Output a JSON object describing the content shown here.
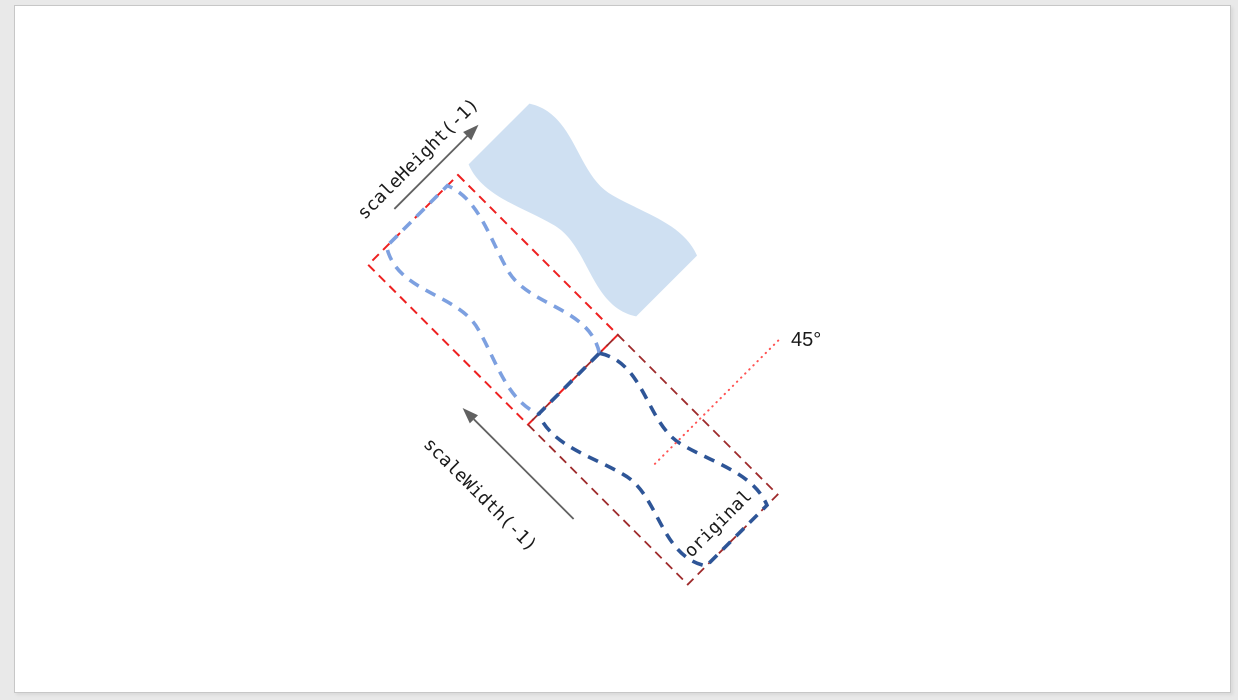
{
  "diagram": {
    "labels": {
      "scale_height": "scaleHeight(-1)",
      "scale_width": "scaleWidth(-1)",
      "original": "original",
      "angle": "45°"
    },
    "rotation_degrees": 45,
    "colors": {
      "flag_fill": "#cfe0f2",
      "flipped_stroke": "#7da0e0",
      "original_stroke": "#2e5597",
      "flipped_box": "#ee2020",
      "original_box": "#9e2a2b",
      "angle_line": "#ff5252",
      "arrow": "#616161",
      "label_text": "#1a1a1a",
      "page_bg": "#ffffff",
      "surround_bg": "#e9e9e9",
      "page_border": "#c7c7c7"
    }
  }
}
